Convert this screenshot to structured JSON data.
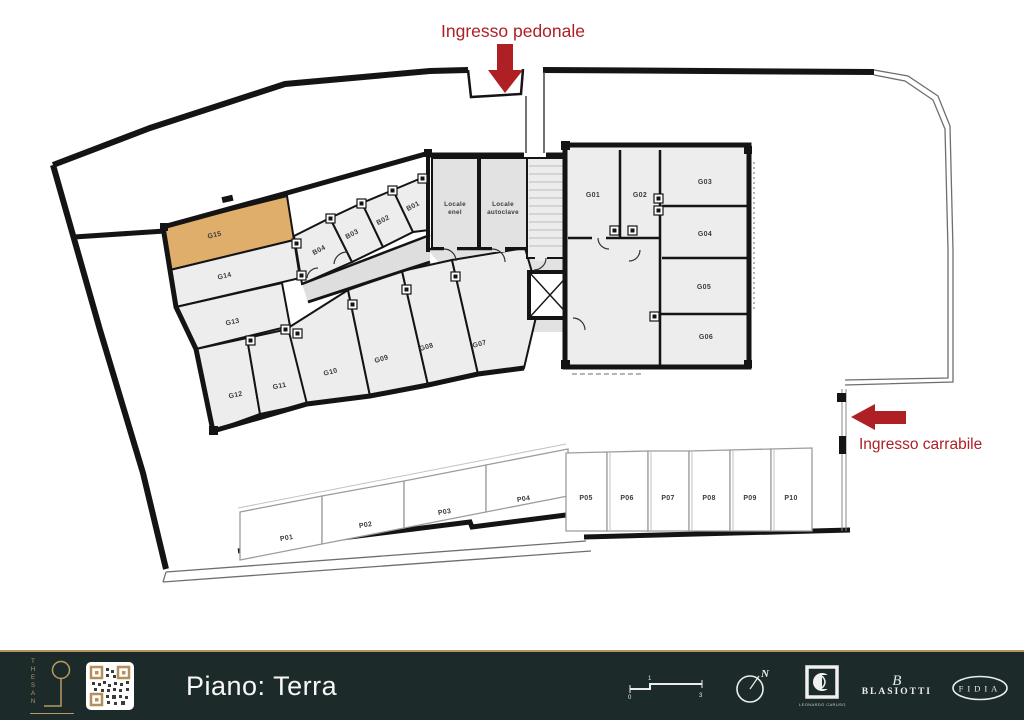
{
  "plan": {
    "pedestrian_entrance_label": "Ingresso pedonale",
    "vehicle_entrance_label": "Ingresso carrabile",
    "accent_red": "#ae2024",
    "highlight_color": "#dfae6b",
    "highlighted_unit": "G15",
    "rooms": {
      "G01": "G01",
      "G02": "G02",
      "G03": "G03",
      "G04": "G04",
      "G05": "G05",
      "G06": "G06",
      "G07": "G07",
      "G08": "G08",
      "G09": "G09",
      "G10": "G10",
      "G11": "G11",
      "G12": "G12",
      "G13": "G13",
      "G14": "G14",
      "G15": "G15",
      "B01": "B01",
      "B02": "B02",
      "B03": "B03",
      "B04": "B04"
    },
    "utility": {
      "enel": [
        "Locale",
        "enel"
      ],
      "autoclave": [
        "Locale",
        "autoclave"
      ]
    },
    "parking": {
      "P01": "P01",
      "P02": "P02",
      "P03": "P03",
      "P04": "P04",
      "P05": "P05",
      "P06": "P06",
      "P07": "P07",
      "P08": "P08",
      "P09": "P09",
      "P10": "P10"
    }
  },
  "footer": {
    "floor_title": "Piano: Terra",
    "brand_name": "THESAN",
    "compass_north": "N",
    "scale": {
      "zero": "0",
      "one": "1",
      "three": "3"
    },
    "logos": {
      "caruso": "LEONARDO CARUSO",
      "blasiotti_monogram": "B",
      "blasiotti": "BLASIOTTI",
      "fidia": "FIDIA"
    }
  }
}
